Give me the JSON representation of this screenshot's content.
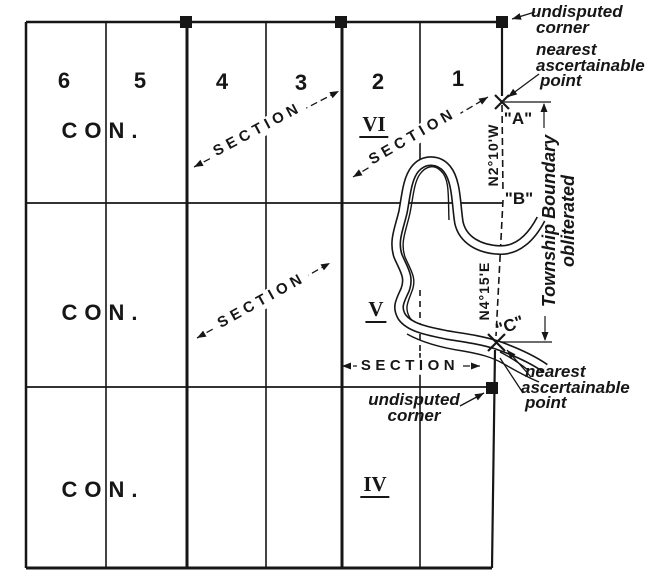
{
  "colors": {
    "background": "#ffffff",
    "ink": "#161616"
  },
  "grid": {
    "section_numbers": [
      "6",
      "5",
      "4",
      "3",
      "2",
      "1"
    ],
    "rows": [
      {
        "concession_label": "CON.",
        "numeral": "VI"
      },
      {
        "concession_label": "CON.",
        "numeral": "V"
      },
      {
        "concession_label": "CON.",
        "numeral": "IV"
      }
    ]
  },
  "labels": {
    "section_line": "SECTION",
    "bearing_ab": "N2°10'W",
    "bearing_bc": "N4°15'E",
    "township_boundary": {
      "line1": "Township Boundary",
      "line2": "obliterated"
    },
    "points": {
      "a": "\"A\"",
      "b": "\"B\"",
      "c": "\"C\""
    }
  },
  "annotations": {
    "undisputed_corner_top": {
      "line1": "undisputed",
      "line2": "corner"
    },
    "nearest_point_top": {
      "line1": "nearest",
      "line2": "ascertainable",
      "line3": "point"
    },
    "nearest_point_bottom": {
      "line1": "nearest",
      "line2": "ascertainable",
      "line3": "point"
    },
    "undisputed_corner_bottom": {
      "line1": "undisputed",
      "line2": "corner"
    }
  }
}
